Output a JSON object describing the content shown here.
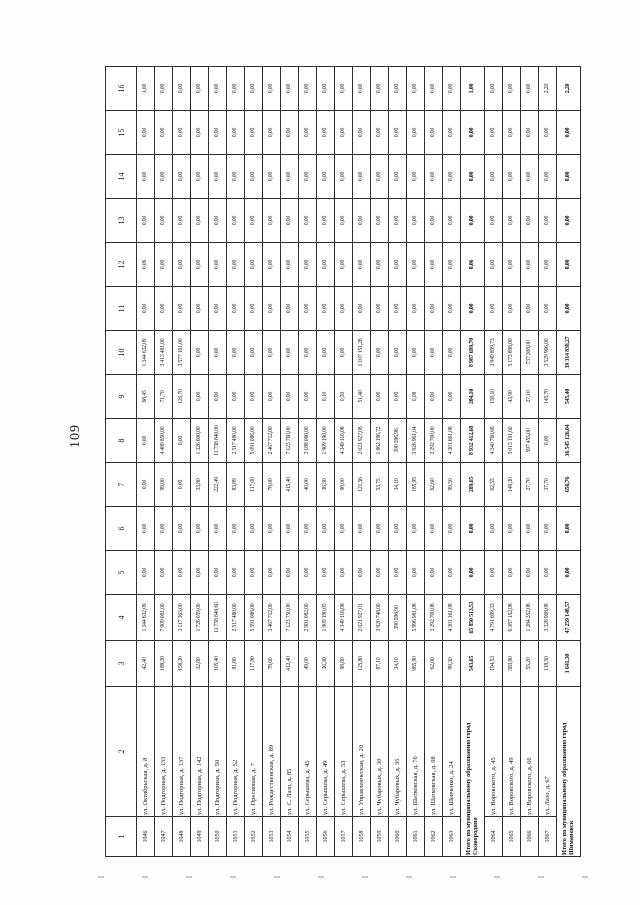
{
  "page": {
    "number": "109"
  },
  "table": {
    "column_numbers": [
      "1",
      "2",
      "3",
      "4",
      "5",
      "6",
      "7",
      "8",
      "9",
      "10",
      "11",
      "12",
      "13",
      "14",
      "15",
      "16"
    ],
    "rows": [
      {
        "type": "data",
        "id": "1046",
        "address": "ул. Октябрьская, д. 8",
        "values": [
          "42,40",
          "1 344 632,09",
          "0,00",
          "0,00",
          "0,00",
          "0,00",
          "68,45",
          "1 344 632,09",
          "0,00",
          "0,06",
          "0,00",
          "0,00",
          "0,00",
          "1,00"
        ]
      },
      {
        "type": "data",
        "id": "1047",
        "address": "ул. Подгорная, д. 133",
        "values": [
          "189,30",
          "7 909 081,00",
          "0,00",
          "0,00",
          "99,00",
          "4 489 850,00",
          "71,70",
          "3 413 481,00",
          "0,00",
          "0,00",
          "0,00",
          "0,00",
          "0,00",
          "0,00"
        ]
      },
      {
        "type": "data",
        "id": "1048",
        "address": "ул. Подгорная, д. 137",
        "values": [
          "158,30",
          "3 117 363,00",
          "0,00",
          "0,00",
          "0,00",
          "0,00",
          "120,70",
          "3 577 161,00",
          "0,00",
          "0,00",
          "0,00",
          "0,00",
          "0,00",
          "0,00"
        ]
      },
      {
        "type": "data",
        "id": "1049",
        "address": "ул. Подгорная, д. 142",
        "values": [
          "32,80",
          "1 726 059,00",
          "0,00",
          "0,00",
          "33,80",
          "1 326 600,00",
          "0,00",
          "0,00",
          "0,00",
          "0,00",
          "0,00",
          "0,00",
          "0,00",
          "0,00"
        ]
      },
      {
        "type": "data",
        "id": "1050",
        "address": "ул. Подгорная, д. 50",
        "values": [
          "105,40",
          "11 758 849,60",
          "0,00",
          "0,00",
          "222,49",
          "11 738 840,00",
          "0,00",
          "0,00",
          "0,00",
          "0,00",
          "0,00",
          "0,00",
          "0,00",
          "0,00"
        ]
      },
      {
        "type": "data",
        "id": "1051",
        "address": "ул. Подгорная, д. 52",
        "values": [
          "81,80",
          "2 517 480,00",
          "0,00",
          "0,00",
          "83,89",
          "2 517 480,00",
          "0,00",
          "0,00",
          "0,00",
          "0,00",
          "0,00",
          "0,00",
          "0,00",
          "0,00"
        ]
      },
      {
        "type": "data",
        "id": "1052",
        "address": "ул. Пресновая, д. 7",
        "values": [
          "117,80",
          "5 591 086,00",
          "0,00",
          "0,00",
          "117,00",
          "5 091 086,00",
          "0,00",
          "0,00",
          "0,00",
          "0,00",
          "0,00",
          "0,00",
          "0,00",
          "0,00"
        ]
      },
      {
        "type": "data",
        "id": "1053",
        "address": "ул. Рождественская, д. 89",
        "values": [
          "78,60",
          "3 467 712,00",
          "0,00",
          "0,00",
          "78,00",
          "2 467 712,00",
          "0,00",
          "0,00",
          "0,00",
          "0,00",
          "0,00",
          "0,00",
          "0,00",
          "0,00"
        ]
      },
      {
        "type": "data",
        "id": "1054",
        "address": "ул. С. Лазо, д. 85",
        "values": [
          "412,40",
          "7 123 750,00",
          "0,00",
          "0,00",
          "415,40",
          "7 123 760,00",
          "0,00",
          "0,00",
          "0,00",
          "0,00",
          "0,00",
          "0,00",
          "0,00",
          "0,00"
        ]
      },
      {
        "type": "data",
        "id": "1055",
        "address": "ул. Серышева, д. 45",
        "values": [
          "49,00",
          "2 981 082,00",
          "0,00",
          "0,00",
          "40,00",
          "3 188 060,00",
          "0,00",
          "0,00",
          "0,00",
          "0,00",
          "0,00",
          "0,00",
          "0,00",
          "0,00"
        ]
      },
      {
        "type": "data",
        "id": "1056",
        "address": "ул. Серышева, д. 49",
        "values": [
          "36,30",
          "1 909 190,05",
          "0,00",
          "0,00",
          "36,30",
          "1 909 190,00",
          "0,10",
          "0,00",
          "0,00",
          "0,00",
          "0,00",
          "0,00",
          "0,00",
          "0,00"
        ]
      },
      {
        "type": "data",
        "id": "1057",
        "address": "ул. Серышева, д. 53",
        "values": [
          "98,80",
          "4 349 116,08",
          "0,00",
          "0,00",
          "98,00",
          "4 349 116,08",
          "0,50",
          "0,00",
          "0,00",
          "0,00",
          "0,00",
          "0,00",
          "0,00",
          "0,00"
        ]
      },
      {
        "type": "data",
        "id": "1058",
        "address": "ул. Управленческая, д. 20",
        "values": [
          "125,80",
          "2 021 927,01",
          "0,00",
          "0,00",
          "121,56",
          "2 021 927,08",
          "51,40",
          "1 107 151,28",
          "0,00",
          "0,00",
          "0,00",
          "0,00",
          "0,00",
          "0,00"
        ]
      },
      {
        "type": "data",
        "id": "1059",
        "address": "ул. Чубаровых, д. 30",
        "values": [
          "87,10",
          "3 920 748,00",
          "0,00",
          "0,00",
          "53,75",
          "1 862 196,72",
          "0,00",
          "0,00",
          "0,00",
          "0,00",
          "0,00",
          "0,00",
          "0,00",
          "0,00"
        ]
      },
      {
        "type": "data",
        "id": "1060",
        "address": "ул. Чубаровых, д. 35",
        "values": [
          "34,10",
          "390 596,90",
          "0,00",
          "0,00",
          "34,10",
          "390 596,96",
          "0,00",
          "0,00",
          "0,00",
          "0,00",
          "0,00",
          "0,00",
          "0,00",
          "0,00"
        ]
      },
      {
        "type": "data",
        "id": "1061",
        "address": "ул. Шатковская, д. 76",
        "values": [
          "985,90",
          "5 996 981,08",
          "0,00",
          "0,00",
          "185,95",
          "3 926 961,04",
          "0,08",
          "0,00",
          "0,00",
          "0,00",
          "0,00",
          "0,00",
          "0,00",
          "0,00"
        ]
      },
      {
        "type": "data",
        "id": "1062",
        "address": "ул. Шатковская, д. 98",
        "values": [
          "62,00",
          "3 292 700,08",
          "0,00",
          "0,00",
          "62,60",
          "3 292 700,00",
          "0,00",
          "0,00",
          "0,00",
          "0,00",
          "0,00",
          "0,00",
          "0,00",
          "0,00"
        ]
      },
      {
        "type": "data",
        "id": "1063",
        "address": "ул. Шевченко, д. 24",
        "values": [
          "99,30",
          "4 301 161,08",
          "0,00",
          "0,00",
          "99,50",
          "4 301 661,08",
          "0,00",
          "0,00",
          "0,00",
          "0,00",
          "0,00",
          "0,00",
          "0,00",
          "0,00"
        ]
      },
      {
        "type": "total",
        "id": "",
        "address": "Итого по муниципальному образованию город Сковородино",
        "values": [
          "543,65",
          "65 850 513,53",
          "0,00",
          "0,00",
          "289,65",
          "8 932 412,68",
          "204,10",
          "8 987 699,70",
          "0,00",
          "0,06",
          "0,00",
          "0,00",
          "0,00",
          "1,00"
        ]
      },
      {
        "type": "data",
        "id": "1064",
        "address": "ул. Воровского, д. 45",
        "values": [
          "194,53",
          "4 791 699,33",
          "0,00",
          "0,00",
          "62,55",
          "4 240 760,68",
          "150,10",
          "3 949 899,73",
          "0,00",
          "0,00",
          "0,00",
          "0,00",
          "0,00",
          "0,00"
        ]
      },
      {
        "type": "data",
        "id": "1065",
        "address": "ул. Воровского, д. 49",
        "values": [
          "383,90",
          "6 387 152,08",
          "0,00",
          "0,00",
          "149,30",
          "5 013 191,60",
          "43,90",
          "5 173 898,00",
          "0,00",
          "0,00",
          "0,00",
          "0,00",
          "0,00",
          "0,00"
        ]
      },
      {
        "type": "data",
        "id": "1066",
        "address": "ул. Воровского, д. 66",
        "values": [
          "55,20",
          "1 284 352,08",
          "0,00",
          "0,00",
          "27,70",
          "597 455,00",
          "27,10",
          "737 308,00",
          "0,00",
          "0,00",
          "0,00",
          "0,00",
          "0,00",
          "0,00"
        ]
      },
      {
        "type": "data",
        "id": "1067",
        "address": "ул. Лазо, д. 67",
        "values": [
          "118,50",
          "3 328 908,08",
          "0,00",
          "0,00",
          "37,70",
          "0,00",
          "145,70",
          "3 529 966,00",
          "0,00",
          "0,00",
          "0,00",
          "0,00",
          "0,00",
          "2,20"
        ]
      },
      {
        "type": "total",
        "id": "",
        "address": "Итого по муниципальному образованию город Шимановск",
        "values": [
          "1 641,30",
          "47 259 148,57",
          "0,00",
          "0,00",
          "656,76",
          "36 545 126,04",
          "545,40",
          "39 314 838,27",
          "0,00",
          "0,00",
          "0,00",
          "0,00",
          "0,00",
          "2,20"
        ]
      }
    ]
  }
}
